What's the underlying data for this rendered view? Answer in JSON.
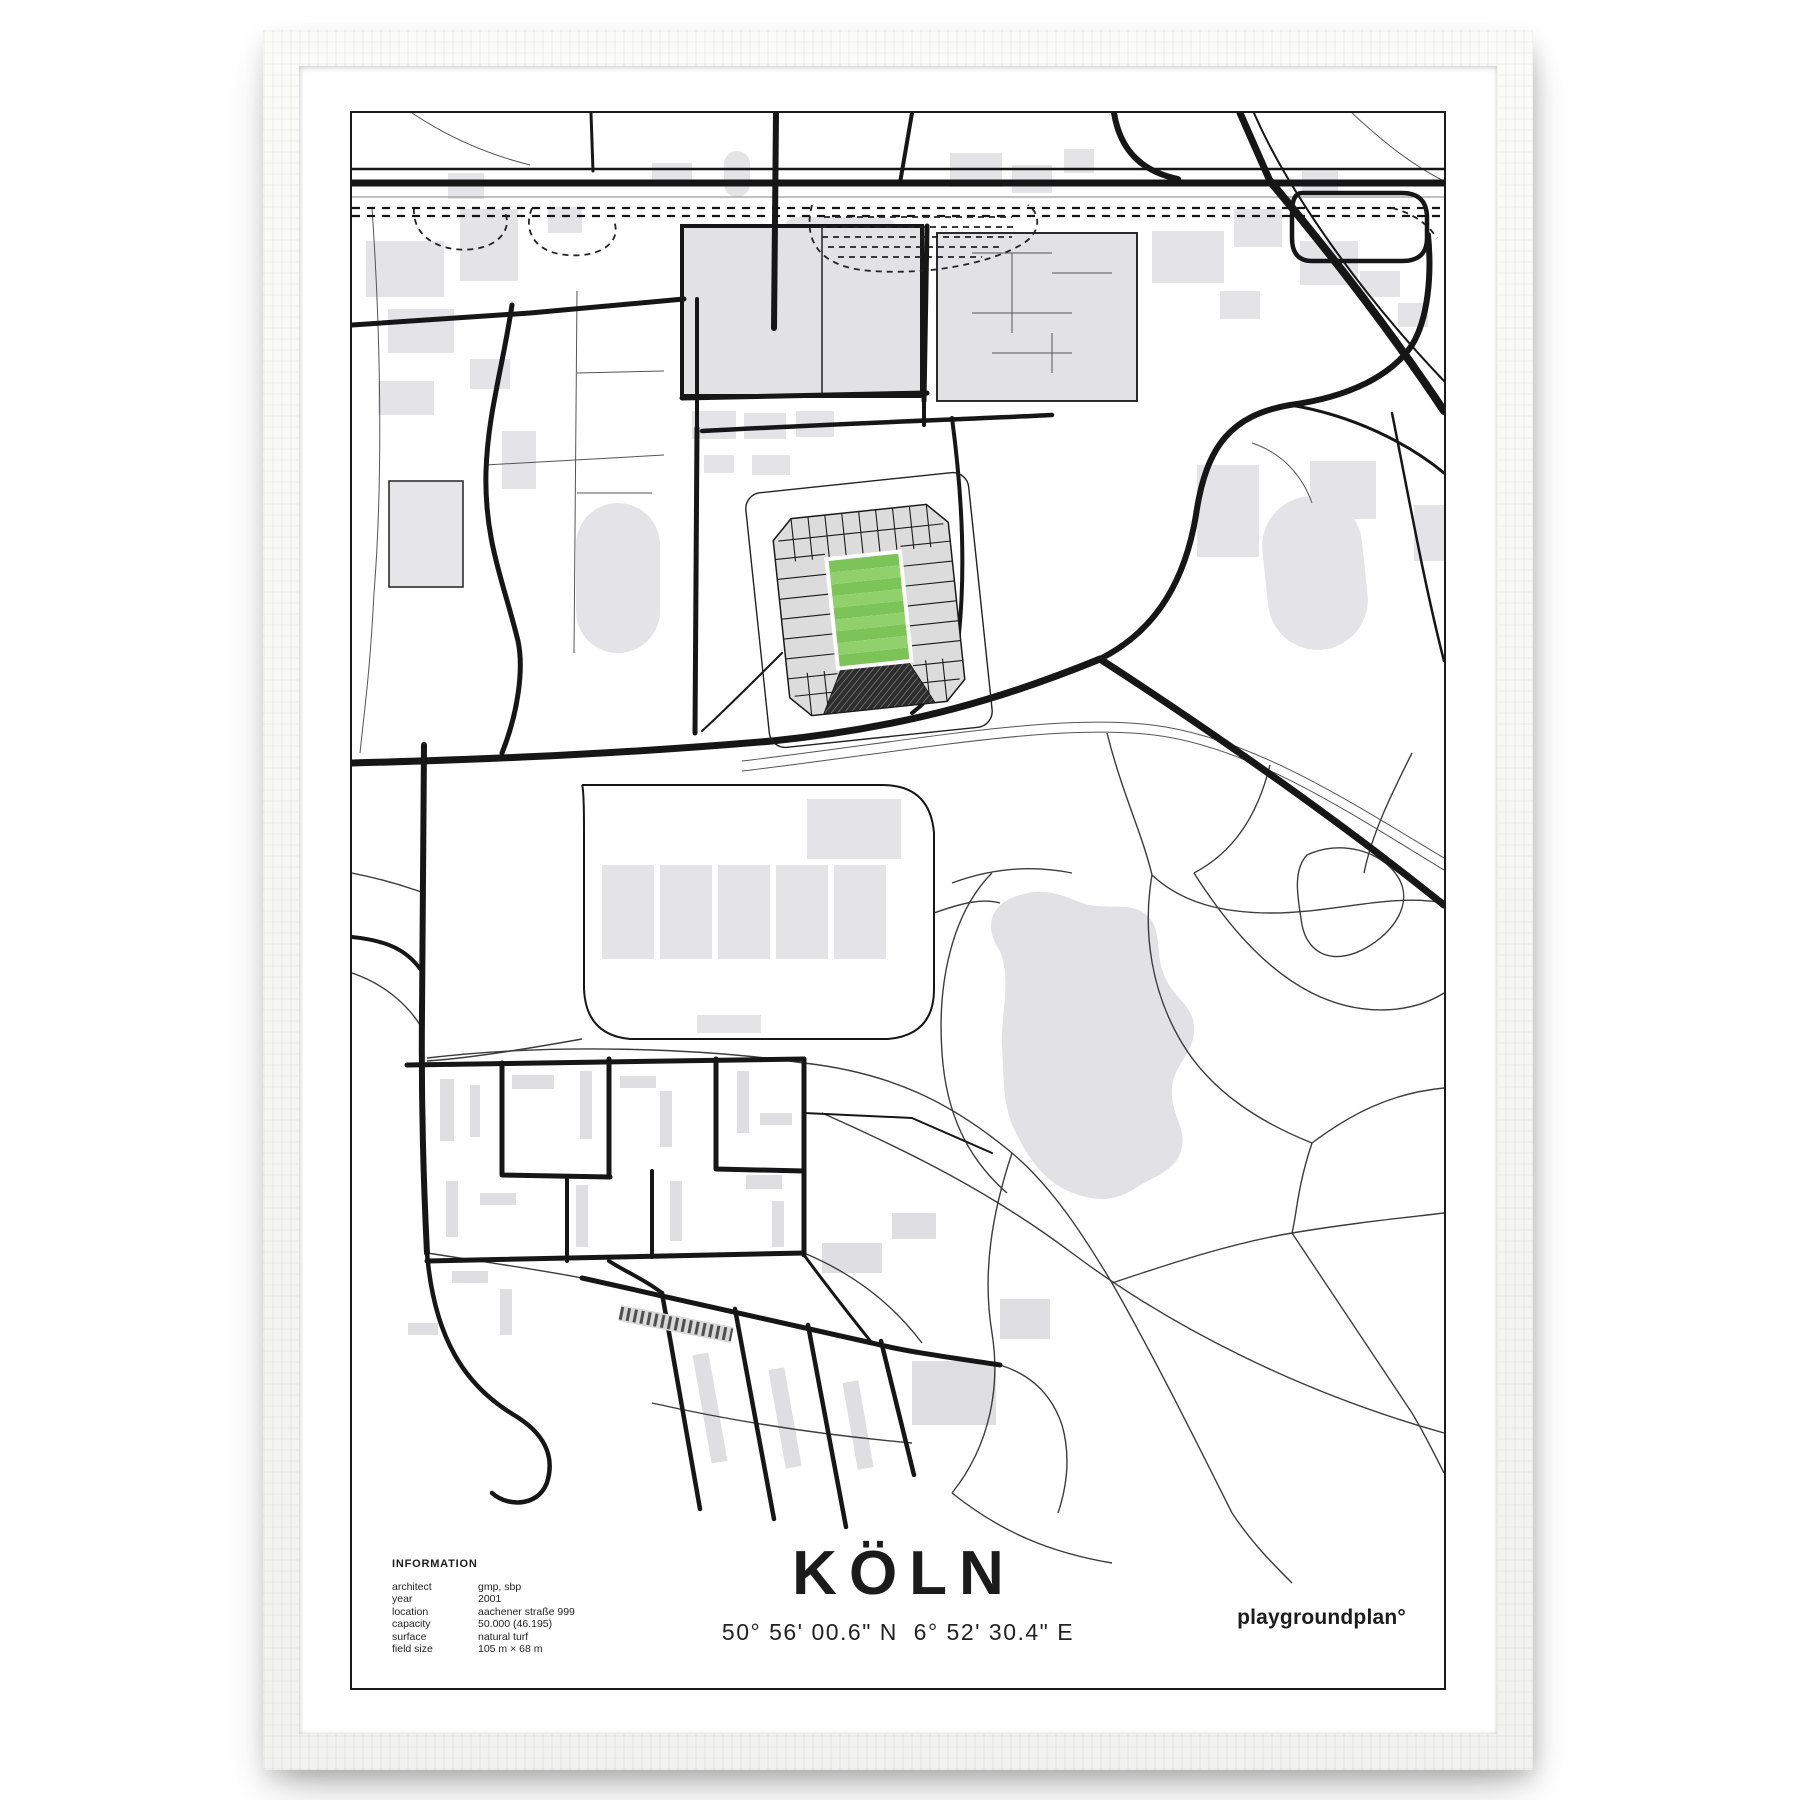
{
  "poster": {
    "title": "KÖLN",
    "coordinates": "50° 56' 00.6\" N  6° 52' 30.4\" E",
    "brand": "playgroundplan°",
    "info": {
      "heading": "INFORMATION",
      "rows": [
        {
          "label": "architect",
          "value": "gmp, sbp"
        },
        {
          "label": "year",
          "value": "2001"
        },
        {
          "label": "location",
          "value": "aachener straße 999"
        },
        {
          "label": "capacity",
          "value": "50.000 (46.195)"
        },
        {
          "label": "surface",
          "value": "natural turf"
        },
        {
          "label": "field size",
          "value": "105 m × 68 m"
        }
      ]
    },
    "map": {
      "description_icon": "stadium-map",
      "highlight": "stadium-pitch"
    },
    "colors": {
      "pitch_green_light": "#90d16c",
      "pitch_green_dark": "#7cc457",
      "map_gray": "#e4e4e6",
      "road_black": "#161616"
    }
  }
}
